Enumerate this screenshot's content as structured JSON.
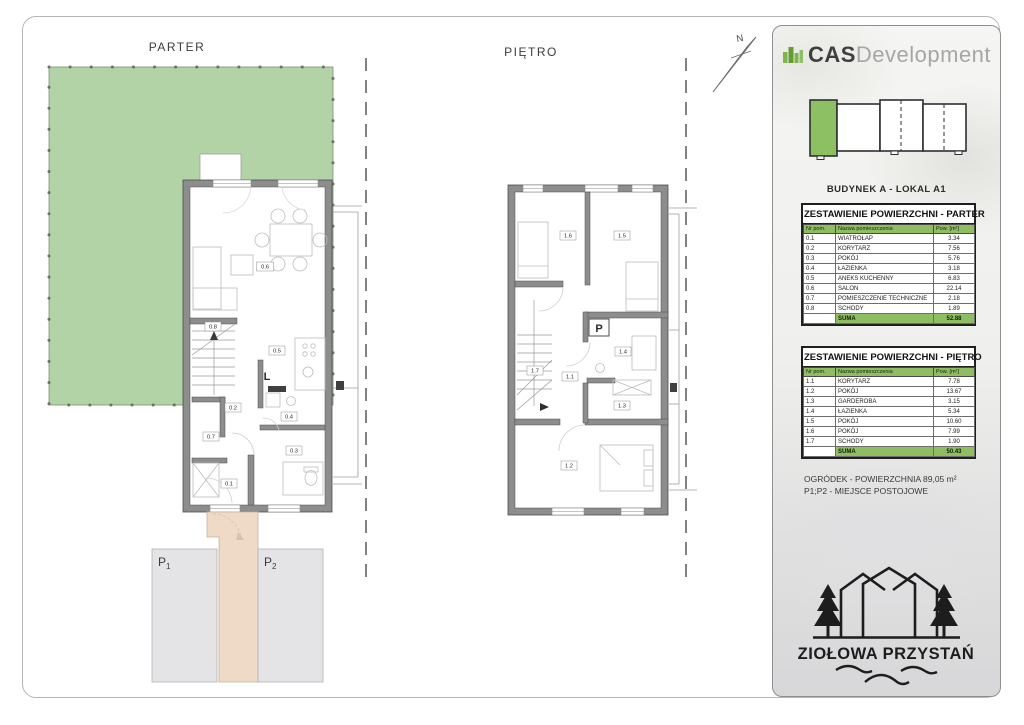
{
  "titles": {
    "parter": "PARTER",
    "pietro": "PIĘTRO",
    "north": "N"
  },
  "parter": {
    "labels": {
      "r01": "0.1",
      "r02": "0.2",
      "r03": "0.3",
      "r04": "0.4",
      "r05": "0.5",
      "r06": "0.6",
      "r07": "0.7",
      "r08": "0.8",
      "fridge": "L"
    }
  },
  "pietro": {
    "labels": {
      "r11": "1.1",
      "r12": "1.2",
      "r13": "1.3",
      "r14": "1.4",
      "r15": "1.5",
      "r16": "1.6",
      "r17": "1.7",
      "washer": "P"
    }
  },
  "parking": {
    "p1": "P",
    "p1_sub": "1",
    "p2": "P",
    "p2_sub": "2"
  },
  "sidebar": {
    "brand": {
      "bold": "CAS",
      "light": "Development"
    },
    "building_label": "BUDYNEK A - LOKAL A1",
    "tables": [
      {
        "title": "ZESTAWIENIE POWIERZCHNI - PARTER",
        "headers": [
          "Nr pom.",
          "Nazwa pomieszczenia",
          "Pow. [m²]"
        ],
        "rows": [
          [
            "0.1",
            "WIATROŁAP",
            "3.34"
          ],
          [
            "0.2",
            "KORYTARZ",
            "7.56"
          ],
          [
            "0.3",
            "POKÓJ",
            "5.76"
          ],
          [
            "0.4",
            "ŁAZIENKA",
            "3.18"
          ],
          [
            "0.5",
            "ANEKS KUCHENNY",
            "6.83"
          ],
          [
            "0.6",
            "SALON",
            "22.14"
          ],
          [
            "0.7",
            "POMIESZCZENIE TECHNICZNE",
            "2.18"
          ],
          [
            "0.8",
            "SCHODY",
            "1.89"
          ]
        ],
        "sum_label": "SUMA",
        "sum_value": "52.88"
      },
      {
        "title": "ZESTAWIENIE POWIERZCHNI - PIĘTRO",
        "headers": [
          "Nr pom.",
          "Nazwa pomieszczenia",
          "Pow. [m²]"
        ],
        "rows": [
          [
            "1.1",
            "KORYTARZ",
            "7.78"
          ],
          [
            "1.2",
            "POKÓJ",
            "13.67"
          ],
          [
            "1.3",
            "GARDEROBA",
            "3.15"
          ],
          [
            "1.4",
            "ŁAZIENKA",
            "5.34"
          ],
          [
            "1.5",
            "POKÓJ",
            "10.60"
          ],
          [
            "1.6",
            "POKÓJ",
            "7.99"
          ],
          [
            "1.7",
            "SCHODY",
            "1.90"
          ]
        ],
        "sum_label": "SUMA",
        "sum_value": "50.43"
      }
    ],
    "notes": [
      "OGRÓDEK - POWIERZCHNIA 89,05 m²",
      "P1;P2 - MIEJSCE POSTOJOWE"
    ],
    "logo_text": "ZIOŁOWA PRZYSTAŃ"
  },
  "colors": {
    "garden_green": "#b1d3a6",
    "table_green": "#8fbe62",
    "logo_green": "#7fb54a",
    "wall_gray": "#8d8d8d",
    "path_beige": "#eedac6",
    "parking_gray": "#e4e4e7"
  }
}
